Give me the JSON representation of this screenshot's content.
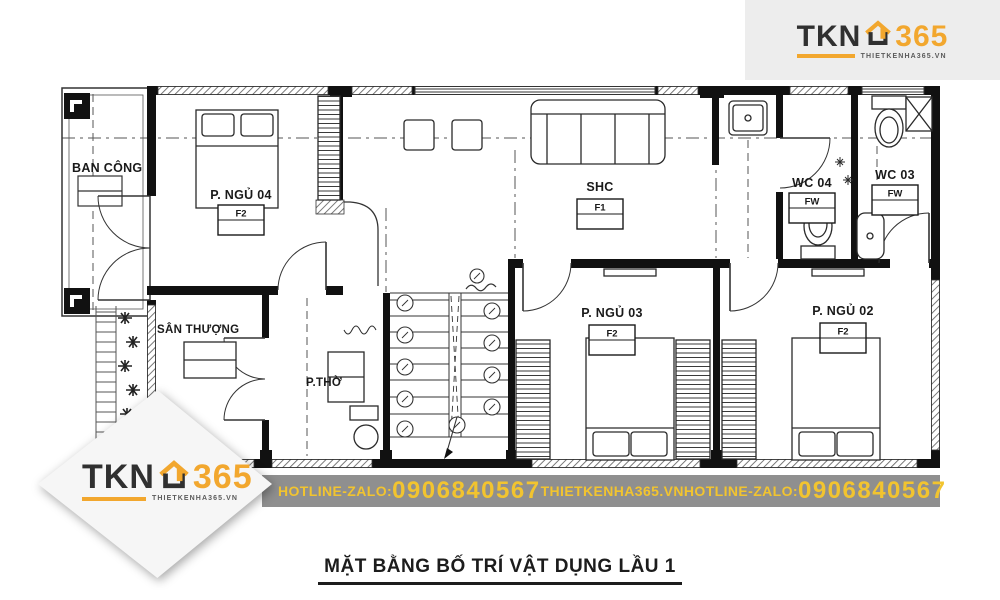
{
  "brand": {
    "name_dark": "TKN",
    "name_accent": "365",
    "tagline": "THIETKENHA365.VN",
    "accent_color": "#F2A72E",
    "dark_color": "#303030"
  },
  "banner": {
    "bg_color": "#8F8F8F",
    "text_color": "#F2C42F",
    "hotline_label_1": "HOTLINE-ZALO:",
    "phone_1": "0906840567",
    "website": "THIETKENHA365.VN",
    "hotline_label_2": "HOTLINE-ZALO:",
    "phone_2": "0906840567"
  },
  "drawing_title": "MẶT BẰNG BỐ TRÍ VẬT DỤNG LẦU 1",
  "rooms": {
    "balcony": {
      "label": "BAN CÔNG"
    },
    "bedroom_04": {
      "label": "P. NGỦ 04",
      "code": "F2"
    },
    "living": {
      "label": "SHC",
      "code": "F1"
    },
    "wc_04": {
      "label": "WC 04",
      "code": "FW"
    },
    "wc_03": {
      "label": "WC 03",
      "code": "FW"
    },
    "terrace": {
      "label": "SÂN THƯỢNG"
    },
    "altar_room": {
      "label": "P.THỜ"
    },
    "bedroom_03": {
      "label": "P. NGỦ 03",
      "code": "F2"
    },
    "bedroom_02": {
      "label": "P. NGỦ 02",
      "code": "F2"
    }
  }
}
